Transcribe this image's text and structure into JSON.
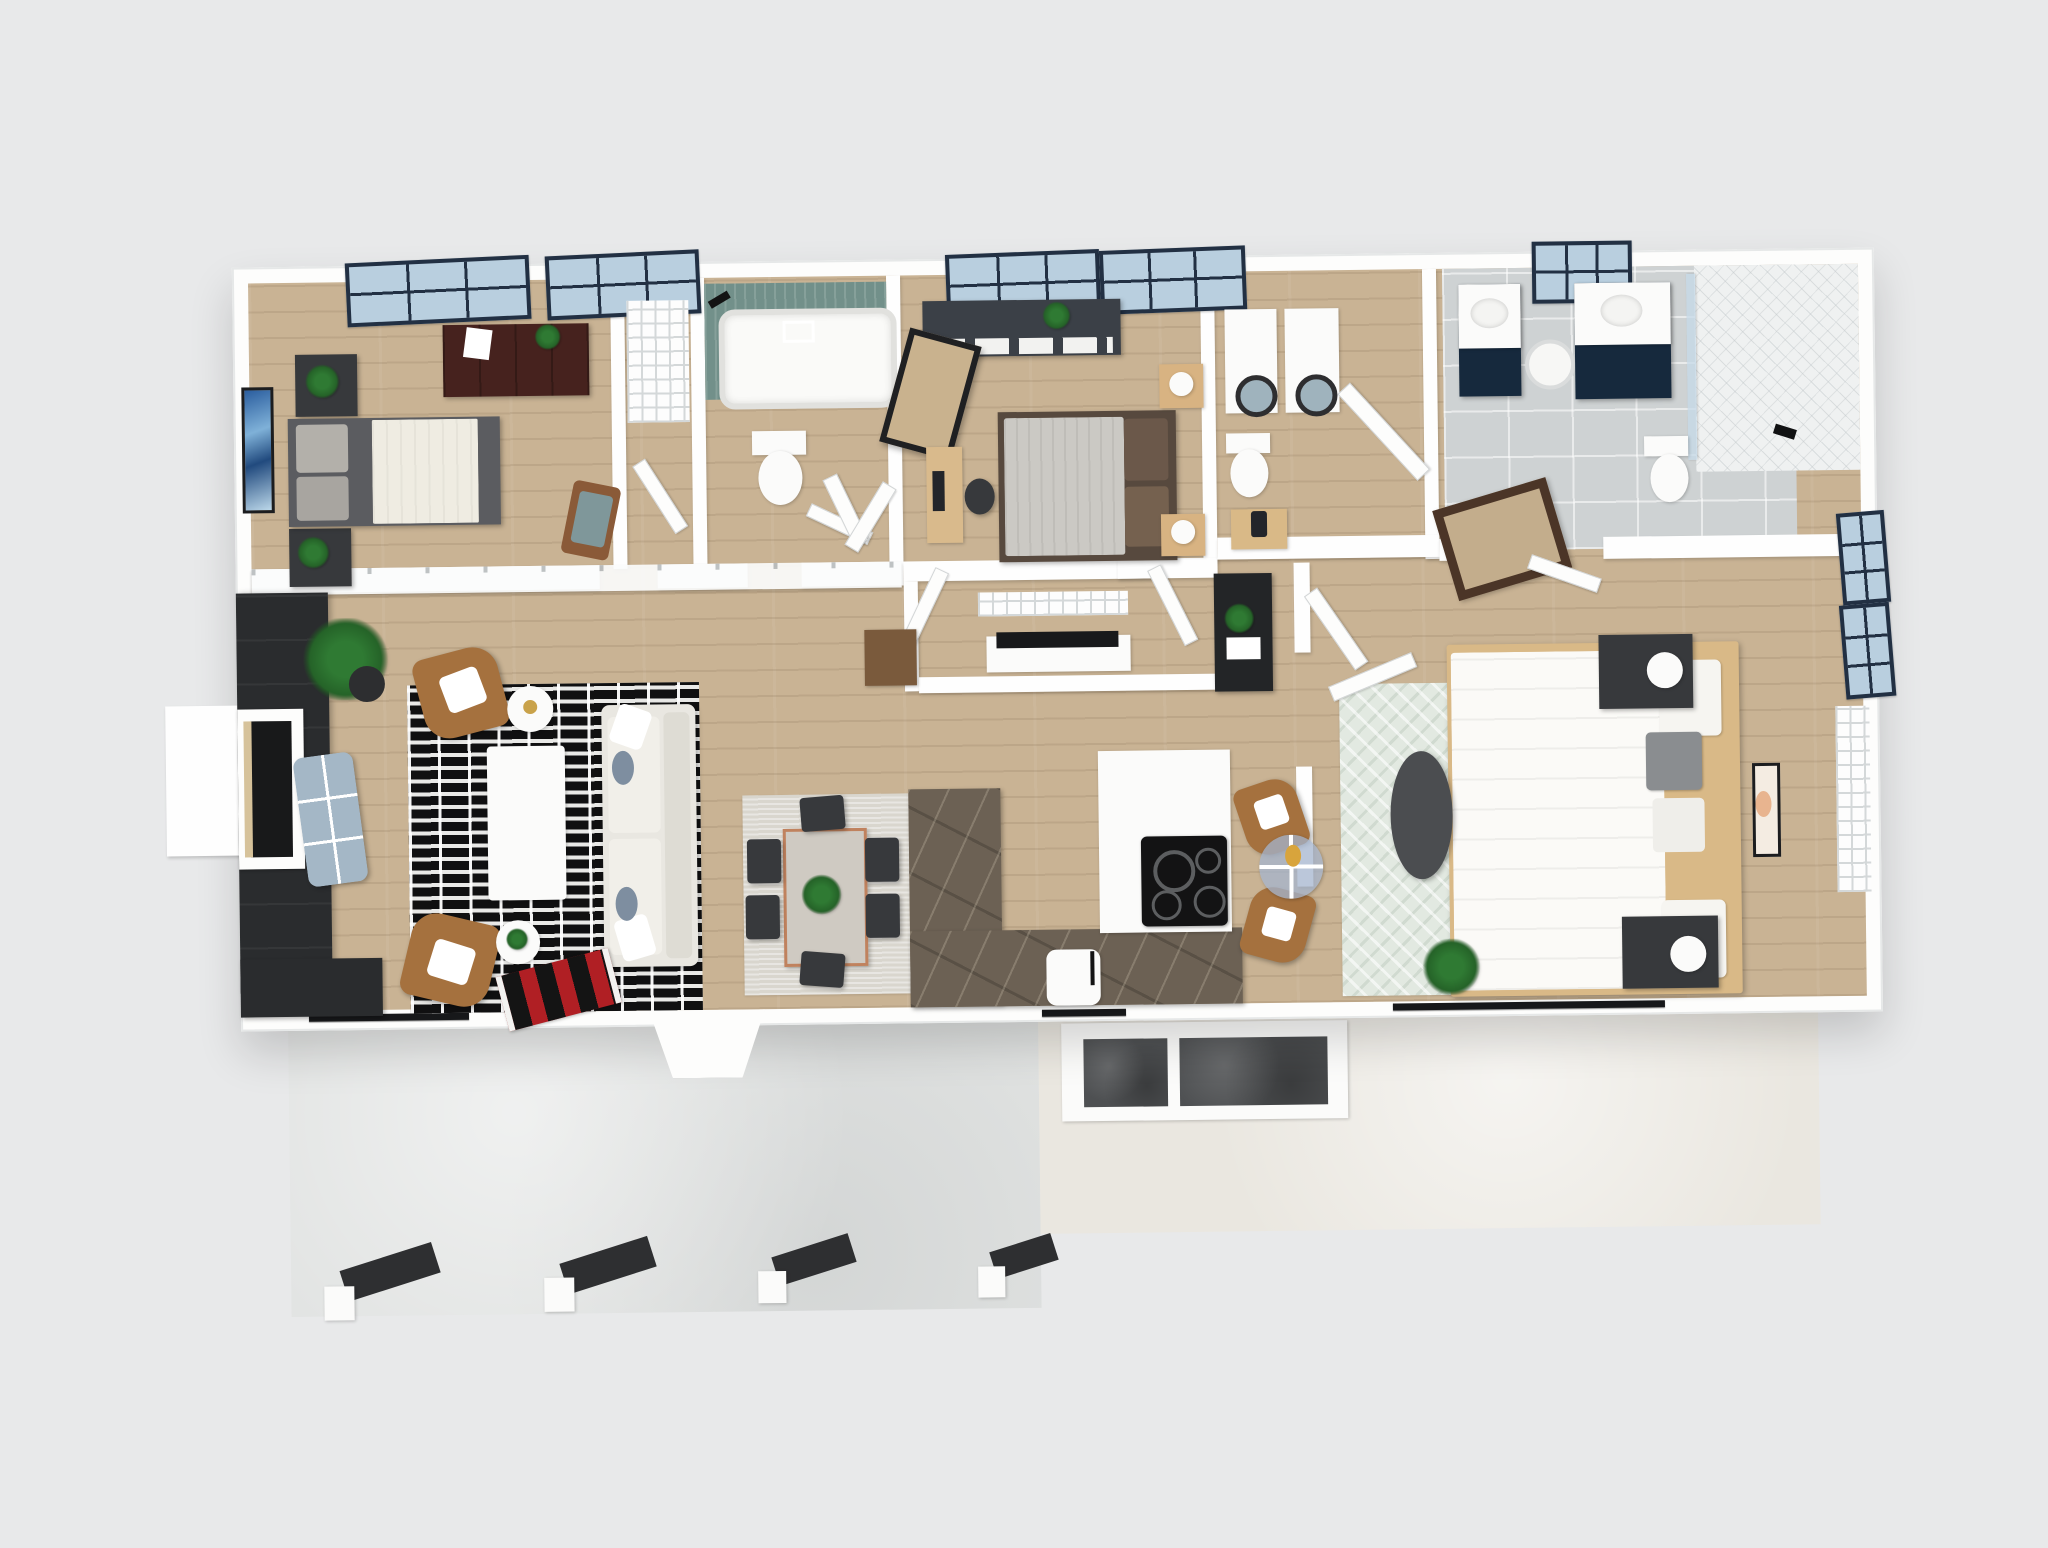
{
  "scene": {
    "description": "3D rendered top-down dollhouse floor plan of a single-story 3-bedroom 2.5-bath home with front porch and rear patio",
    "view": "overhead isometric render",
    "visible_text": ""
  },
  "palette": {
    "bg": "#e8e9ea",
    "wood": "#c9b394",
    "wall": "#fdfdfc",
    "winframe": "#223043",
    "glass": "#b9cfdf",
    "tealtile": "#72908a",
    "graytile": "#ced2d3",
    "marble": "#6c6154",
    "navy": "#16293d",
    "charcoal": "#2a2c2e",
    "cream_sofa": "#e9e7e1",
    "brown_chair": "#a5713e",
    "maroon_dresser": "#46221e",
    "mint": "#e2e9e1",
    "red_rug": "#b01f24",
    "blue_ottoman": "#a4b7c6",
    "concreteL": "#e0e2e1",
    "concreteR": "#eae7e0",
    "deckmat": "#4e5052",
    "bed1_gray": "#5b5c60",
    "duvet_white": "#efece2"
  },
  "rooms": [
    {
      "id": "bedroom-1",
      "name": "Bedroom 1",
      "furniture": [
        "queen bed with dark gray frame and white duvet",
        "two dark nightstands with plants",
        "dark maroon dresser",
        "blue abstract wall art",
        "accent chair with teal cushion",
        "double black-frame windows"
      ]
    },
    {
      "id": "closet-1",
      "name": "Bedroom 1 Closet",
      "furniture": [
        "wire shelving",
        "open door"
      ]
    },
    {
      "id": "bathroom-1",
      "name": "Hall Bathroom",
      "furniture": [
        "tub with teal tile surround",
        "black shower fixtures",
        "toilet"
      ]
    },
    {
      "id": "bedroom-2",
      "name": "Bedroom 2",
      "furniture": [
        "bed with light gray bedding and brown pillows",
        "two light-wood nightstands with lamps",
        "charcoal dresser with white storage bins",
        "leaning floor mirror",
        "desk with computer and chair",
        "black-frame windows"
      ]
    },
    {
      "id": "laundry-room",
      "name": "Laundry / Powder Room",
      "furniture": [
        "washer",
        "dryer",
        "toilet",
        "wood side table with lamp"
      ]
    },
    {
      "id": "primary-bathroom",
      "name": "Primary Bathroom",
      "furniture": [
        "two navy vanities with white counters",
        "round hamper",
        "toilet",
        "large white-tile walk-in shower with glass panel",
        "gray tile floor",
        "black-frame window",
        "dark framed floor mirror"
      ]
    },
    {
      "id": "primary-bedroom",
      "name": "Primary Bedroom",
      "furniture": [
        "king bed with white duvet and wood platform",
        "gray accent pillow",
        "two charcoal nightstands with round white lamps",
        "mint trellis rug",
        "dark oval bench",
        "potted plant",
        "framed art",
        "sliding glass door",
        "side windows",
        "built-in shelving"
      ]
    },
    {
      "id": "living-room",
      "name": "Living Room",
      "furniture": [
        "black media wall with fireplace",
        "blue-gray tufted ottoman",
        "black and white striped rug",
        "white coffee table",
        "cream sofa with blue pillows",
        "two brown armchairs with white pillows",
        "two round white side tables",
        "potted plant",
        "red accent runner"
      ]
    },
    {
      "id": "dining-area",
      "name": "Dining Area",
      "furniture": [
        "rectangular table with copper legs",
        "six dark gray chairs",
        "greenery centerpiece",
        "light gray rug"
      ]
    },
    {
      "id": "kitchen",
      "name": "Kitchen",
      "furniture": [
        "L-shaped dark marble counter",
        "white counter with black cooktop",
        "white trash bin",
        "round glass bistro table",
        "two brown chairs",
        "black console with plant",
        "wood cabinet"
      ]
    },
    {
      "id": "entry",
      "name": "Entry",
      "furniture": [
        "bay entry door",
        "red and black runner rug"
      ]
    },
    {
      "id": "front-porch",
      "name": "Front Porch",
      "furniture": [
        "concrete slab",
        "four white posts with dark roof beams"
      ]
    },
    {
      "id": "back-patio",
      "name": "Back Patio",
      "furniture": [
        "cream patio slab",
        "white deck pad",
        "two dark gray mats",
        "sliding door tracks"
      ]
    }
  ],
  "counts": {
    "bedrooms": 3,
    "bathrooms": 3,
    "windows_top_wall": 5,
    "porch_posts": 4,
    "deck_mats": 2
  }
}
